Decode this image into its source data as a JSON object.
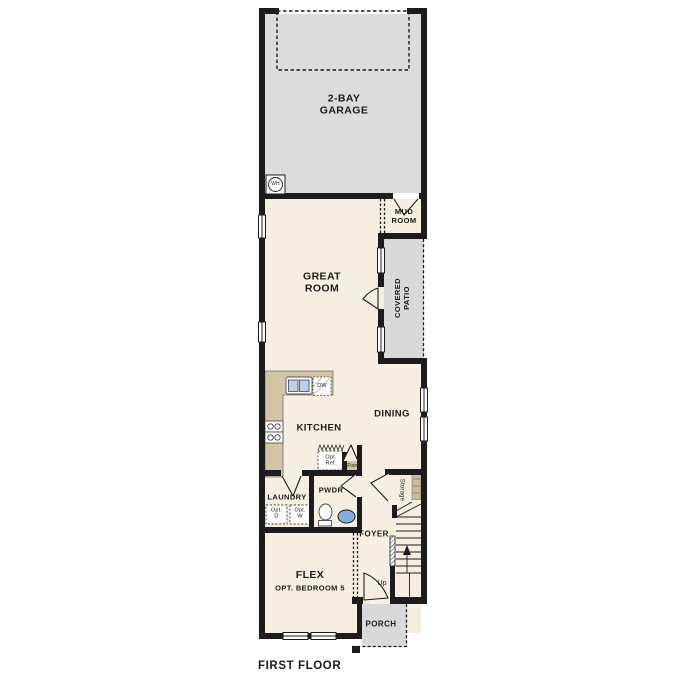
{
  "plan": {
    "title": "FIRST FLOOR",
    "rooms": {
      "garage": {
        "line1": "2-BAY",
        "line2": "GARAGE"
      },
      "mud_room": {
        "line1": "MUD",
        "line2": "ROOM"
      },
      "great_room": {
        "line1": "GREAT",
        "line2": "ROOM"
      },
      "covered_patio": {
        "line1": "COVERED",
        "line2": "PATIO"
      },
      "kitchen": {
        "label": "KITCHEN"
      },
      "dining": {
        "label": "DINING"
      },
      "laundry": {
        "label": "LAUNDRY"
      },
      "powder": {
        "label": "PWDR"
      },
      "foyer": {
        "label": "FOYER"
      },
      "storage": {
        "label": "Storage"
      },
      "flex": {
        "line1": "FLEX",
        "line2": "OPT. BEDROOM 5"
      },
      "porch": {
        "label": "PORCH"
      }
    },
    "fixtures": {
      "water_heater": "WH",
      "dishwasher": "DW",
      "opt_ref": {
        "line1": "Opt.",
        "line2": "Ref."
      },
      "pantry": "Pan",
      "opt_dryer": {
        "line1": "Opt.",
        "line2": "D"
      },
      "opt_washer": {
        "line1": "Opt.",
        "line2": "W"
      },
      "stairs_up": "Up"
    },
    "colors": {
      "wall": "#1c1c1c",
      "interior": "#f6efe1",
      "garage": "#dcdcdc",
      "patio": "#d9d9d9",
      "porch": "#d9d9d9",
      "counter": "#d2c5a6",
      "shelf": "#c9bc9d",
      "sink_basin": "#b9d0ea",
      "powder_sink": "#82b1e0"
    }
  }
}
